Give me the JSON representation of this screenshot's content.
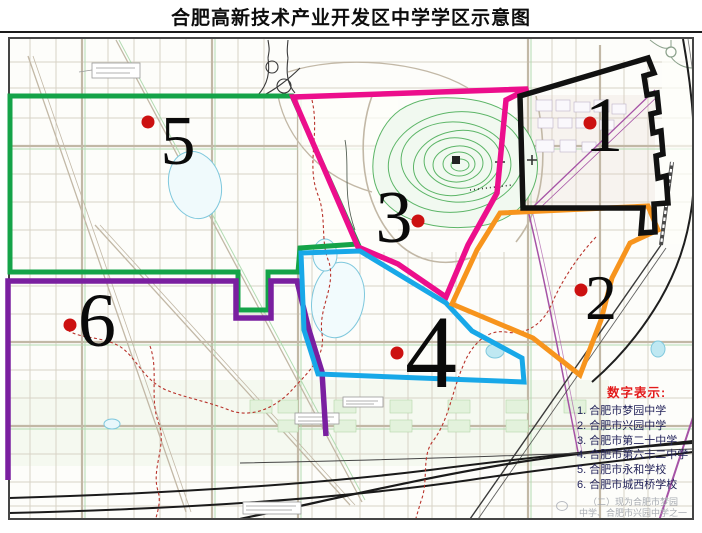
{
  "title": "合肥高新技术产业开发区中学学区示意图",
  "legend": {
    "title": "数字表示:",
    "items": [
      "1. 合肥市梦园中学",
      "2. 合肥市兴园中学",
      "3. 合肥市第二十中学",
      "4. 合肥市第六十二中学",
      "5. 合肥市永和学校",
      "6. 合肥市城西桥学校"
    ]
  },
  "districts": [
    {
      "number": "1",
      "school": "合肥市梦园中学",
      "color": "#111111"
    },
    {
      "number": "2",
      "school": "合肥市兴园中学",
      "color": "#F7941D"
    },
    {
      "number": "3",
      "school": "合肥市第二十中学",
      "color": "#EC0E8C"
    },
    {
      "number": "4",
      "school": "合肥市第六十二中学",
      "color": "#18A8E8"
    },
    {
      "number": "5",
      "school": "合肥市永和学校",
      "color": "#14A348"
    },
    {
      "number": "6",
      "school": "合肥市城西桥学校",
      "color": "#7A1FA0"
    }
  ],
  "markers": {
    "dot_color": "#CC1111"
  },
  "watermark": {
    "line1": "（二）现为合肥市梦园",
    "line2": "中学、合肥市兴园中学之一"
  }
}
